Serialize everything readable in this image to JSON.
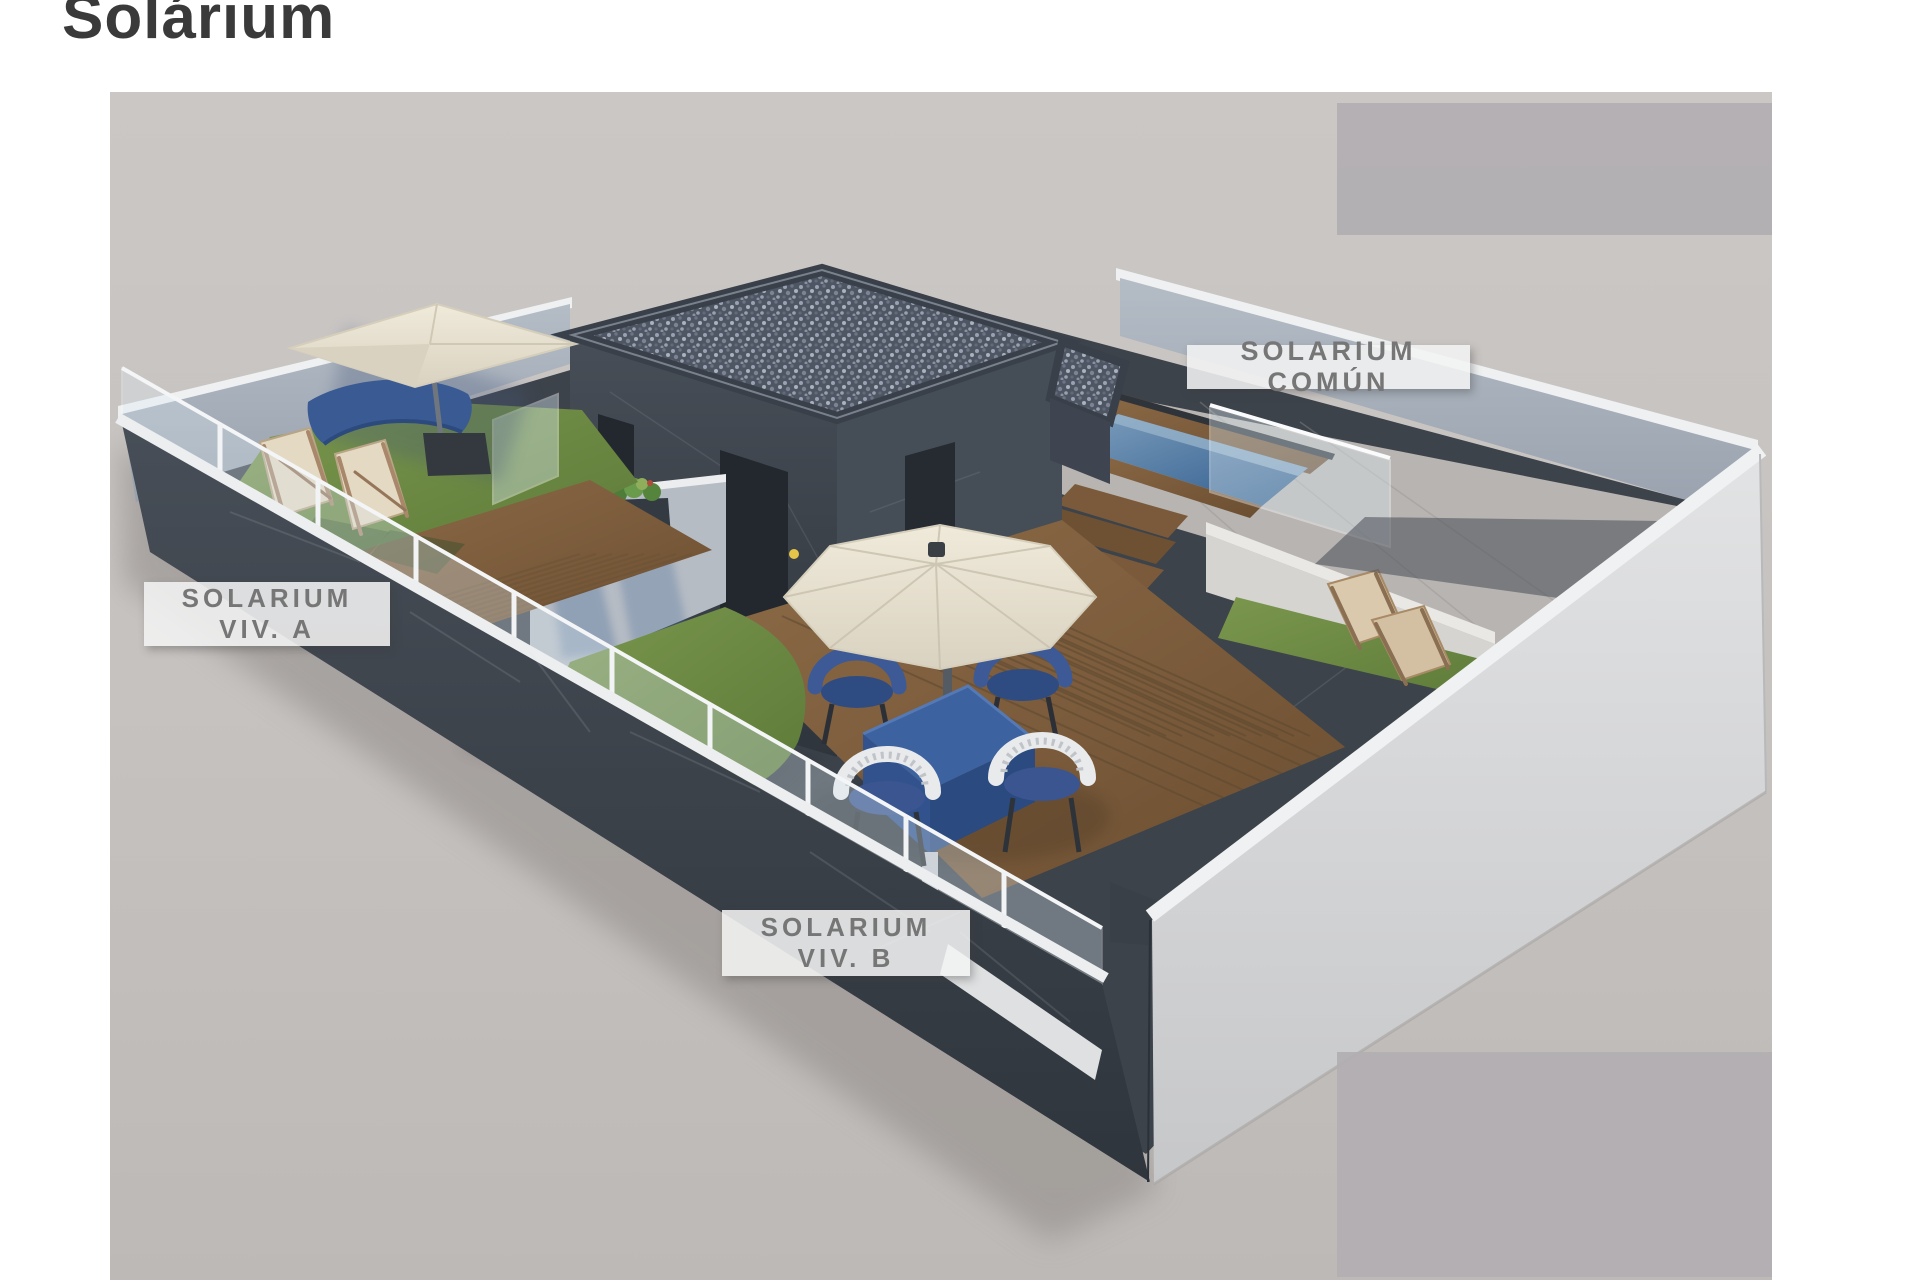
{
  "page": {
    "title": "Solárium"
  },
  "labels": {
    "comun": "SOLARIUM COMÚN",
    "viv_a": [
      "SOLARIUM",
      "VIV. A"
    ],
    "viv_b": [
      "SOLARIUM",
      "VIV. B"
    ]
  },
  "colors": {
    "title_text": "#3a3a3a",
    "label_text": "#767676",
    "label_bg": "rgba(243,243,243,0.88)",
    "ground": "#c6c2c0",
    "wall_dark": "#3f454e",
    "wall_inner_light": "#adb5bf",
    "wall_outer_white": "#dcddde",
    "coping_white": "#eef0f1",
    "wood_deck": "#82613f",
    "grass": "#6f8c44",
    "pool_water": "#3f6c9c",
    "umbrella_cream": "#e9e3d3",
    "furniture_blue": "#3a5a94",
    "watermark_box": "#b2aeb1"
  }
}
